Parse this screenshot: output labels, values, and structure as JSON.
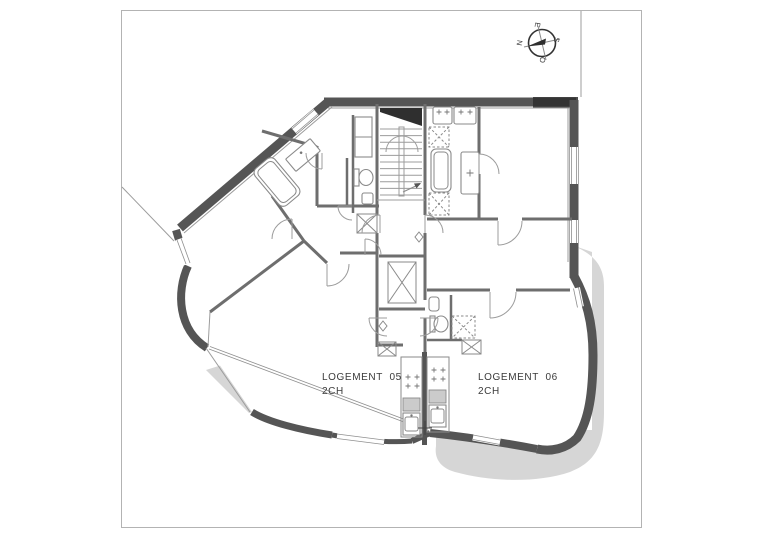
{
  "sheet": {
    "type": "architectural-floor-plan",
    "frame_visible": true
  },
  "units": {
    "unit05": {
      "name": "LOGEMENT  05",
      "rooms": "2CH"
    },
    "unit06": {
      "name": "LOGEMENT  06",
      "rooms": "2CH"
    }
  },
  "compass": {
    "n": "N",
    "e": "E",
    "s": "S",
    "w": "O"
  },
  "colors": {
    "paper": "#ffffff",
    "frame": "#b3b3b3",
    "wall_dark": "#555555",
    "wall_mid": "#6e6e6e",
    "line_thin": "#9c9c9c",
    "shadow": "#d6d6d6",
    "text": "#3a3a3a",
    "black": "#2f2f2f"
  }
}
